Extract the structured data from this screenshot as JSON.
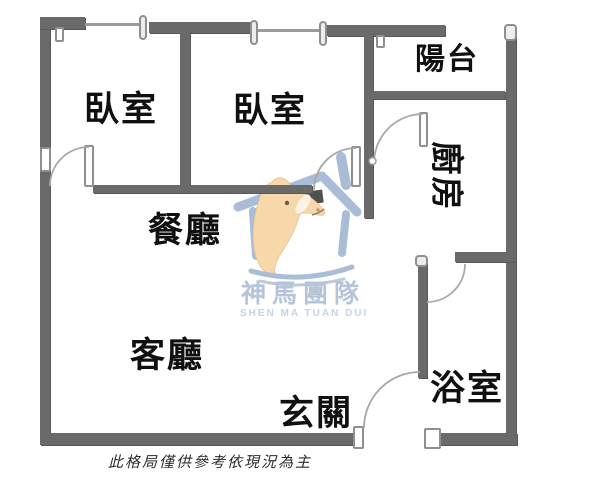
{
  "rooms": [
    {
      "id": "bedroom-1",
      "label": "臥室"
    },
    {
      "id": "bedroom-2",
      "label": "臥室"
    },
    {
      "id": "balcony",
      "label": "陽台"
    },
    {
      "id": "kitchen",
      "label": "廚房"
    },
    {
      "id": "dining",
      "label": "餐廳"
    },
    {
      "id": "living",
      "label": "客廳"
    },
    {
      "id": "entry",
      "label": "玄關"
    },
    {
      "id": "bathroom",
      "label": "浴室"
    }
  ],
  "watermark": {
    "title": "神馬團隊",
    "subtitle": "SHEN MA TUAN DUI"
  },
  "disclaimer": "此格局僅供參考依現況為主",
  "colors": {
    "wall": "#6a6a6a",
    "window_line": "#9b9b9b",
    "door_arc": "#a8a8a8",
    "label_text": "#101010",
    "logo_blue": "#a9bdd6",
    "logo_title_text": "#b5c4d8",
    "logo_subtitle_text": "#c4d4e6",
    "horse": "#f6d8ab",
    "disclaimer_text": "#2c2c2c"
  }
}
